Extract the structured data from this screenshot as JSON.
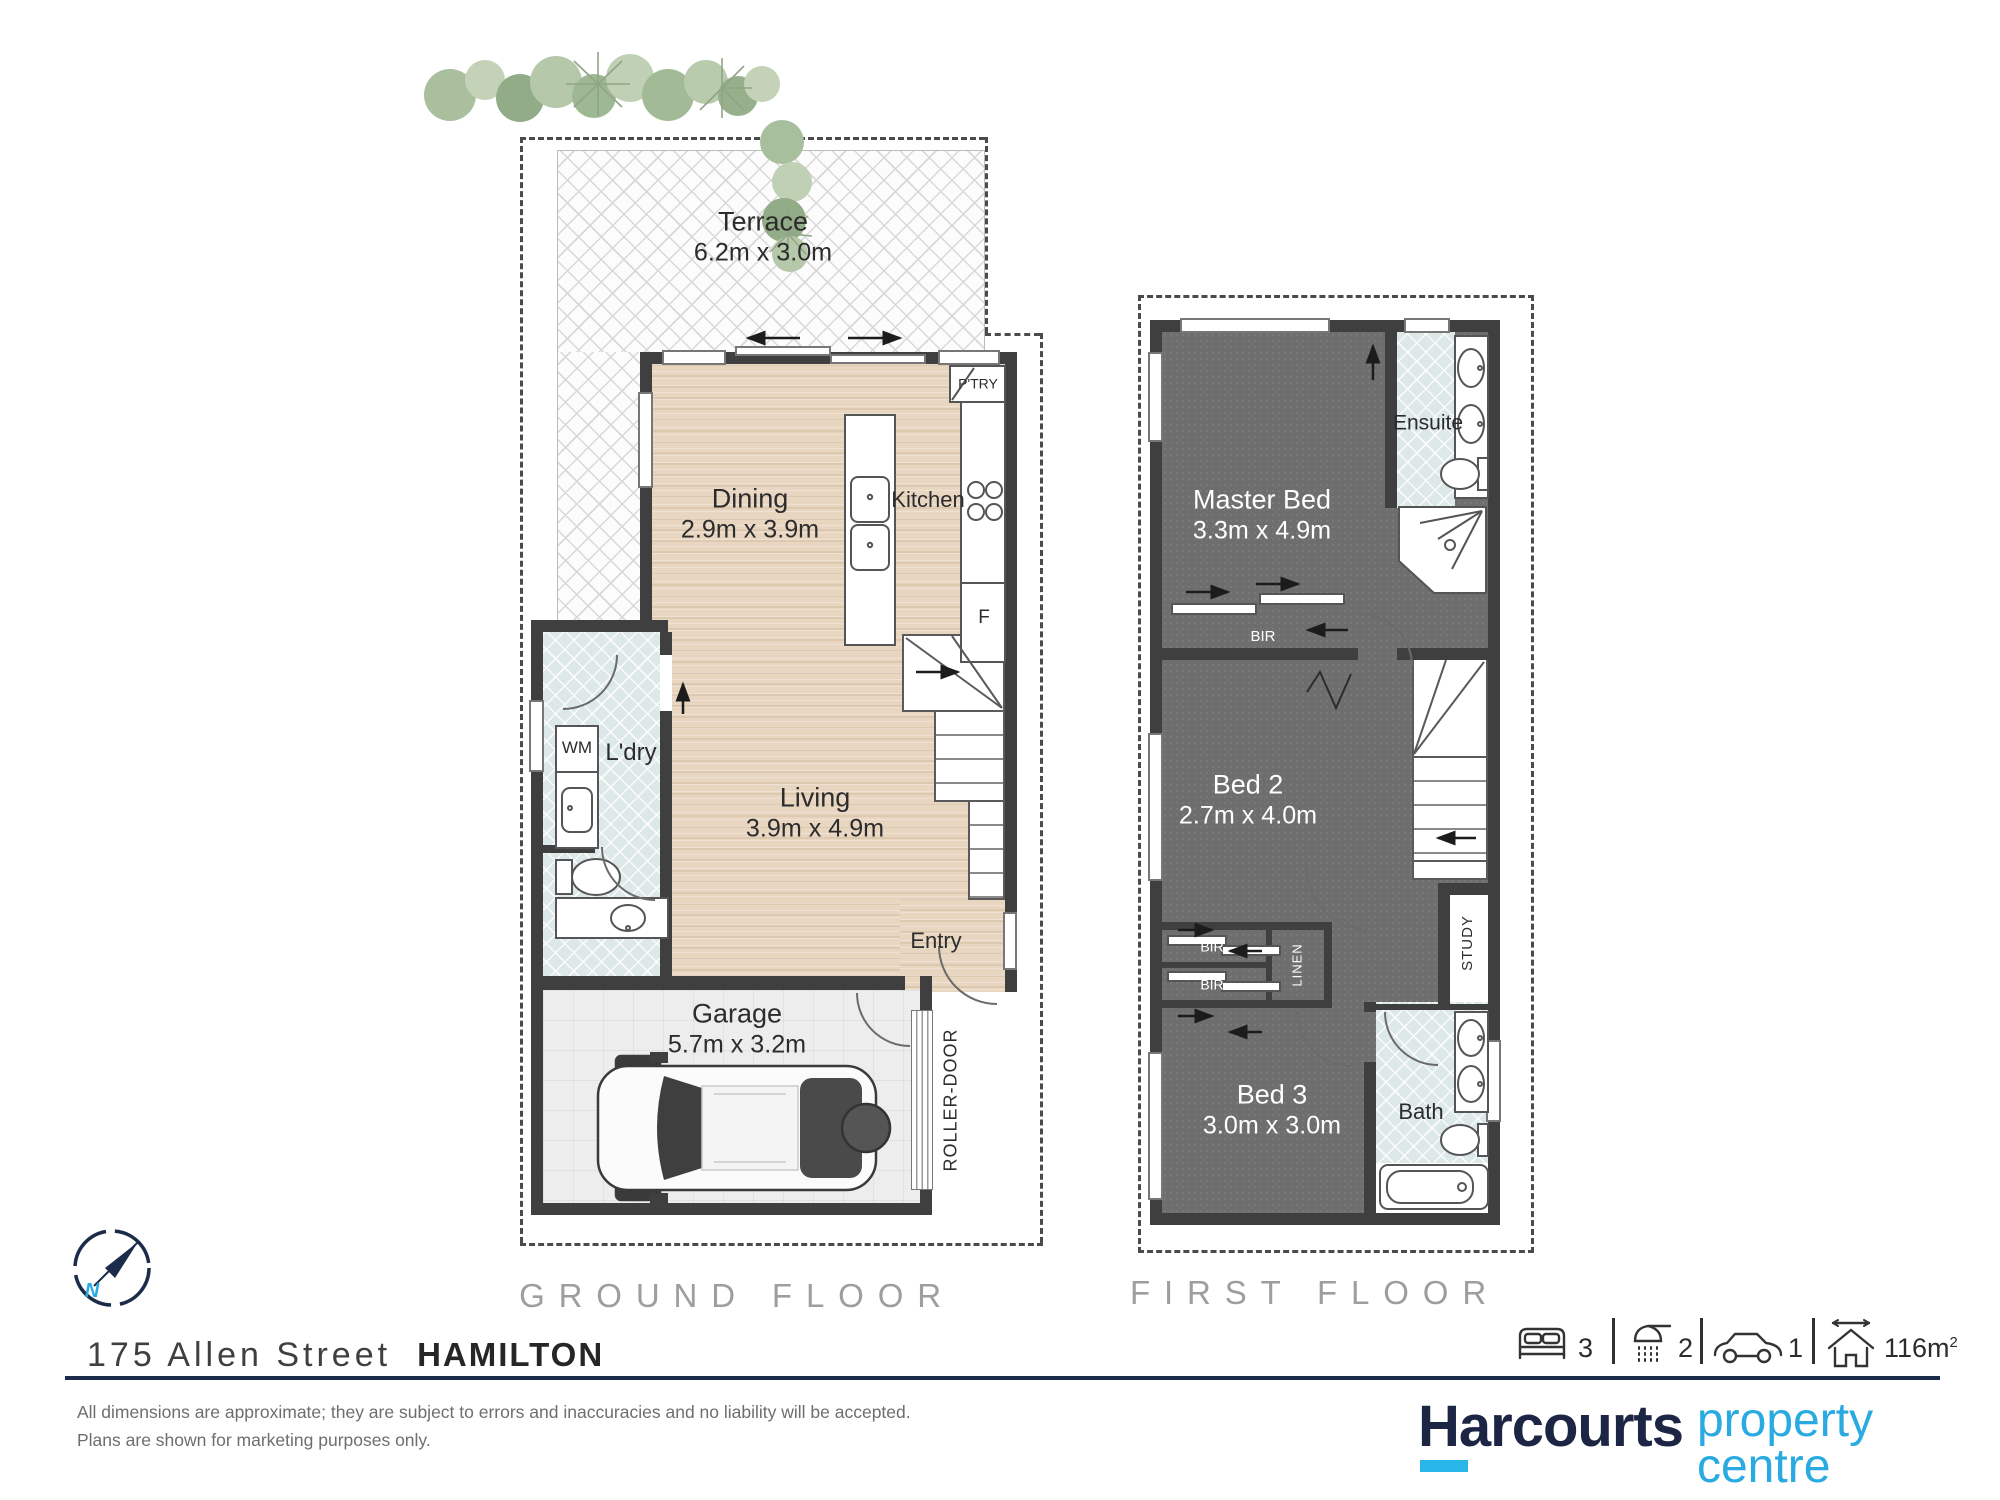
{
  "property": {
    "street": "175 Allen Street",
    "suburb": "HAMILTON",
    "disclaimer1": "All dimensions are approximate; they are subject to errors and inaccuracies and no liability will be accepted.",
    "disclaimer2": "Plans are shown for marketing purposes only.",
    "compass_north": "N"
  },
  "floors": {
    "ground": {
      "caption": "GROUND FLOOR",
      "rooms": {
        "terrace": {
          "name": "Terrace",
          "dims": "6.2m x 3.0m"
        },
        "dining": {
          "name": "Dining",
          "dims": "2.9m x 3.9m"
        },
        "kitchen": {
          "name": "Kitchen"
        },
        "pantry": {
          "name": "P'TRY"
        },
        "fridge": {
          "name": "F"
        },
        "wm": {
          "name": "WM"
        },
        "laundry": {
          "name": "L'dry"
        },
        "living": {
          "name": "Living",
          "dims": "3.9m x 4.9m"
        },
        "entry": {
          "name": "Entry"
        },
        "garage": {
          "name": "Garage",
          "dims": "5.7m x 3.2m"
        },
        "roller_door": {
          "name": "ROLLER-DOOR"
        }
      }
    },
    "first": {
      "caption": "FIRST FLOOR",
      "rooms": {
        "master": {
          "name": "Master Bed",
          "dims": "3.3m x 4.9m"
        },
        "ensuite": {
          "name": "Ensuite"
        },
        "bir_master": {
          "name": "BIR"
        },
        "bed2": {
          "name": "Bed 2",
          "dims": "2.7m x 4.0m"
        },
        "bir_a": {
          "name": "BIR"
        },
        "bir_b": {
          "name": "BIR"
        },
        "linen": {
          "name": "LINEN"
        },
        "study": {
          "name": "STUDY"
        },
        "bed3": {
          "name": "Bed 3",
          "dims": "3.0m x 3.0m"
        },
        "bath": {
          "name": "Bath"
        }
      }
    }
  },
  "summary": {
    "beds": "3",
    "showers": "2",
    "cars": "1",
    "area": "116m",
    "area_sup": "2"
  },
  "brand": {
    "name": "Harcourts",
    "tag1": "property",
    "tag2": "centre",
    "navy": "#1d2545",
    "blue": "#29aae1"
  }
}
